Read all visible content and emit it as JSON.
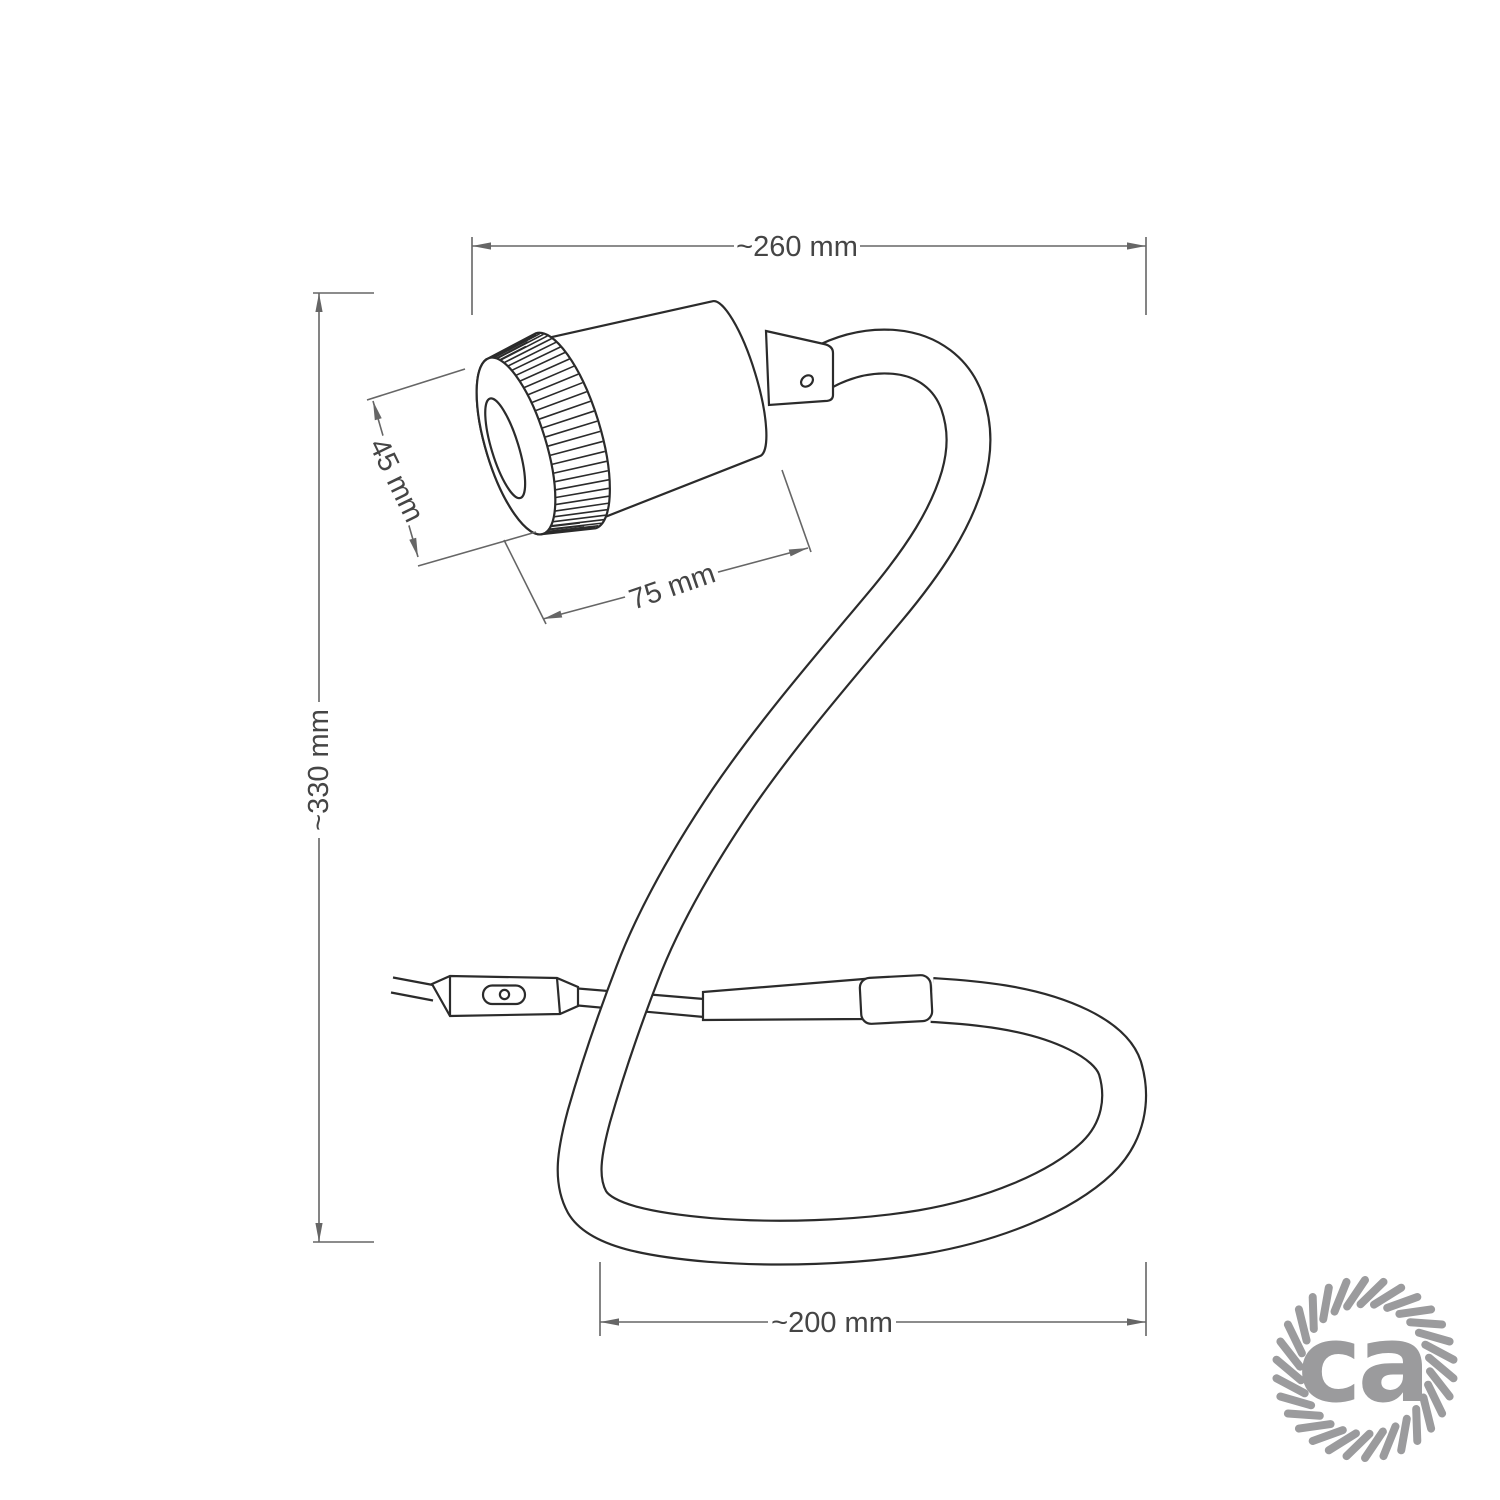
{
  "dimensions": {
    "overall_width": "~260 mm",
    "overall_height": "~330 mm",
    "spotlight_diameter": "45 mm",
    "spotlight_length": "75 mm",
    "cable_loop_width": "~200 mm"
  },
  "logo": {
    "text": "ca",
    "color": "#9b9b9d"
  },
  "style_colors": {
    "outline": "#2b2b2b",
    "dimension_line": "#666666",
    "dimension_text": "#454545",
    "background": "#ffffff"
  }
}
